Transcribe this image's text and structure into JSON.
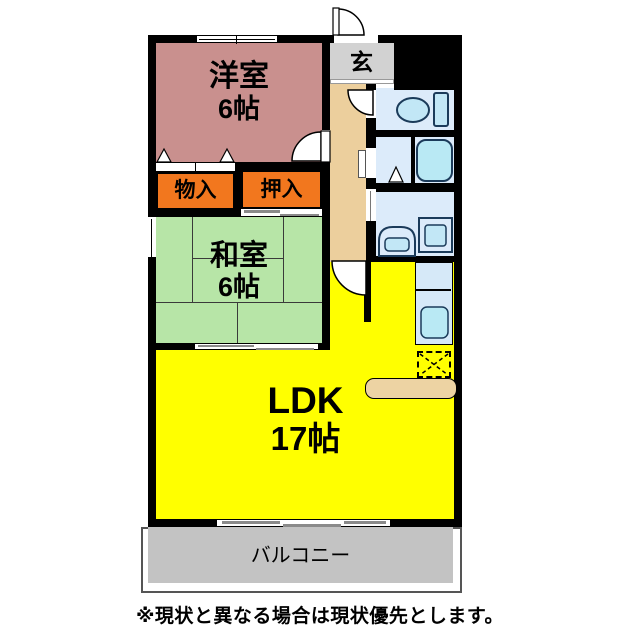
{
  "rooms": {
    "youshitsu": {
      "label": "洋室",
      "size": "6帖"
    },
    "washitsu": {
      "label": "和室",
      "size": "6帖"
    },
    "ldk": {
      "label": "LDK",
      "size": "17帖"
    },
    "monoire": {
      "label": "物入"
    },
    "oshiire": {
      "label": "押入"
    },
    "genkan": {
      "label": "玄"
    },
    "balcony": {
      "label": "バルコニー"
    }
  },
  "note": "※現状と異なる場合は現状優先とします。",
  "colors": {
    "wall": "#000000",
    "youshitsu": "#c9908e",
    "washitsu": "#b7e5a7",
    "ldk": "#ffff00",
    "storage": "#f2771e",
    "genkan": "#d2d2d2",
    "corridor": "#eccf9d",
    "wet_room": "#dcebfa",
    "fixture": "#c2e7f6",
    "fixture_deep": "#b9e9f4",
    "fixture_stroke": "#1b3b5a",
    "kitchen_strip": "#d6e9f8",
    "counter": "#edd3a3",
    "balcony": "#c3c3c3"
  }
}
